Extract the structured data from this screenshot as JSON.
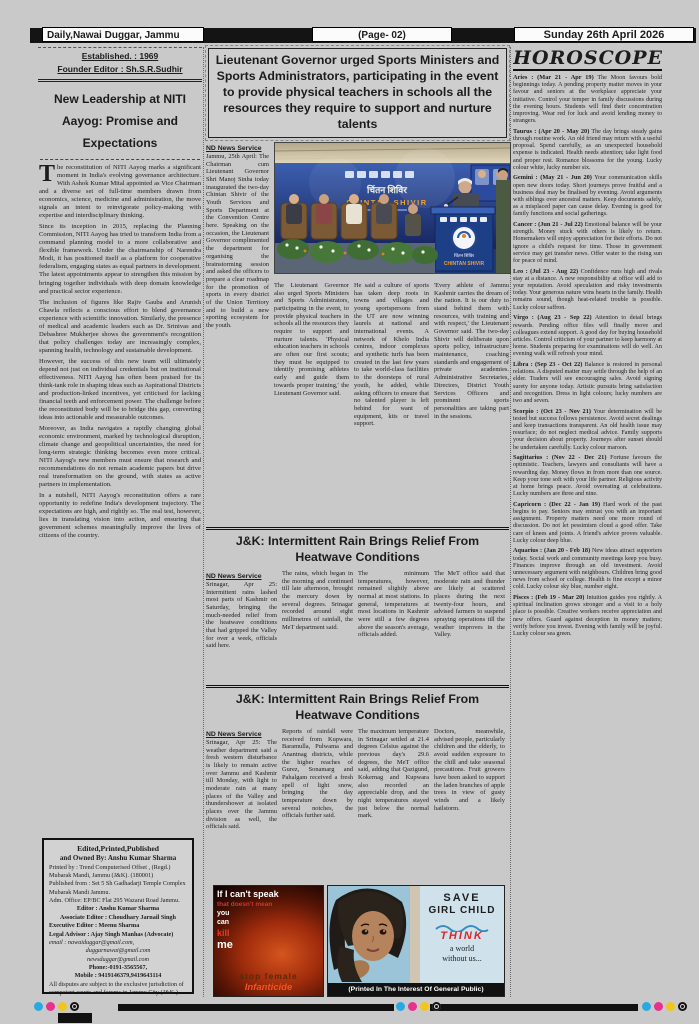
{
  "header": {
    "paper_name": "Daily,Nawai Duggar, Jammu",
    "page_label": "(Page- 02)",
    "date": "Sunday 26th April 2026"
  },
  "masthead": {
    "established": "Established. : 1969",
    "founder": "Founder Editor : Sh.S.R.Sudhir"
  },
  "editorial": {
    "title": "New Leadership at NITI Aayog: Promise and Expectations",
    "dropcap": "T",
    "paragraphs": [
      "he reconstitution of NITI Aayog marks a significant moment in India's evolving governance architecture. With Ashok Kumar Mital appointed as Vice Chairman and a diverse set of full-time members drawn from economics, science, medicine and administration, the move signals an intent to reinvigorate policy-making with expertise and interdisciplinary thinking.",
      "Since its inception in 2015, replacing the Planning Commission, NITI Aayog has tried to transform India from a command planning model to a more collaborative and flexible framework. Under the chairmanship of Narendra Modi, it has positioned itself as a platform for cooperative federalism, engaging states as equal partners in development. The latest appointments appear to strengthen this mission by bringing together individuals with deep domain knowledge and practical sector experience.",
      "The inclusion of figures like Rajiv Gauba and Arunish Chawla reflects a conscious effort to blend governance experience with scientific innovation. Similarly, the presence of medical and academic leaders such as Dr. Srinivas and Debashree Mukherjee shows the government's recognition that policy challenges today are increasingly complex, spanning health, technology and sustainable development.",
      "However, the success of this new team will ultimately depend not just on individual credentials but on institutional effectiveness. NITI Aayog has often been praised for its think-tank role in shaping ideas such as Aspirational Districts and production-linked incentives, yet criticised for lacking financial teeth and enforcement power. The challenge before the reconstituted body will be to bridge this gap, converting ideas into actionable and measurable outcomes.",
      "Moreover, as India navigates a rapidly changing global economic environment, marked by technological disruption, climate change and geopolitical uncertainties, the need for long-term strategic thinking becomes even more critical. NITI Aayog's new members must ensure that research and recommendations do not remain academic papers but drive real transformation on the ground, with states as active partners in implementation.",
      "In a nutshell, NITI Aayog's reconstitution offers a rare opportunity to redefine India's development trajectory. The expectations are high, and rightly so. The real test, however, lies in translating vision into action, and ensuring that government schemes meaningfully improve the lives of citizens of the country."
    ]
  },
  "main_article": {
    "headline": "Lieutenant Governor urged Sports Ministers and Sports Administrators, participating in the event to provide physical teachers in schools all the resources they require to support and nurture talents",
    "byline": "ND News Service",
    "col1": "Jammu, 25th April: The Chairman cum Lieutenant Governor Shri Manoj Sinha today inaugurated the two-day Chintan Shivir of the Youth Services and Sports Department at the Convention Centre here. Speaking on the occasion, the Lieutenant Governor complimented the department for organising the brainstorming session and asked the officers to prepare a clear roadmap for the promotion of sports in every district of the Union Territory and to build a new sporting ecosystem for the youth.",
    "col2": "The Lieutenant Governor also urged Sports Ministers and Sports Administrators, participating in the event, to provide physical teachers in schools all the resources they require to support and nurture talents. 'Physical education teachers in schools are often our first scouts; they must be equipped to identify promising athletes early and guide them towards proper training,' the Lieutenant Governor said.",
    "col3": "He said a culture of sports has taken deep roots in towns and villages and young sportspersons from the UT are now winning laurels at national and international events. A network of Khelo India centres, indoor complexes and synthetic turfs has been created in the last few years to take world-class facilities to the doorsteps of rural youth, he added, while asking officers to ensure that no talented player is left behind for want of equipment, kits or travel support.",
    "col4": "'Every athlete of Jammu Kashmir carries the dream of the nation. It is our duty to stand behind them with resources, with training and with respect,' the Lieutenant Governor said. The two-day Shivir will deliberate upon sports policy, infrastructure maintenance, coaching standards and engagement of private academies. Administrative Secretaries, Directors, District Youth Services Officers and prominent sports personalities are taking part in the sessions.",
    "photo": {
      "banner_hi": "चिंतन शिविर",
      "banner_en": "CHINTAN SHIVIR",
      "podium_hi": "चिंतन शिविर",
      "podium_en": "CHINTAN SHIVIR"
    }
  },
  "rain_article_1": {
    "headline": "J&K: Intermittent Rain Brings Relief From Heatwave Conditions",
    "byline": "ND News Service",
    "cols": [
      "Srinagar, Apr 25: Intermittent rains lashed most parts of Kashmir on Saturday, bringing the much-needed relief from the heatwave conditions that had gripped the Valley for over a week, officials said here.",
      "The rains, which began in the morning and continued till late afternoon, brought the mercury down by several degrees. Srinagar recorded around eight millimetres of rainfall, the MeT department said.",
      "The minimum temperatures, however, remained slightly above normal at most stations. In general, temperatures at most locations in Kashmir were still a few degrees above the season's average, officials added.",
      "The MeT office said that moderate rain and thunder are likely at scattered places during the next twenty-four hours, and advised farmers to suspend spraying operations till the weather improves in the Valley."
    ]
  },
  "rain_article_2": {
    "headline": "J&K: Intermittent Rain Brings Relief From Heatwave Conditions",
    "byline": "ND News Service",
    "cols": [
      "Srinagar, Apr 25: The weather department said a fresh western disturbance is likely to remain active over Jammu and Kashmir till Monday, with light to moderate rain at many places of the Valley and thundershower at isolated places over the Jammu division as well, the officials said.",
      "Reports of rainfall were received from Kupwara, Baramulla, Pulwama and Anantnag districts, while the higher reaches of Gurez, Sonamarg and Pahalgam received a fresh spell of light snow, bringing the day temperature down by several notches, the officials further said.",
      "The maximum temperature in Srinagar settled at 21.4 degrees Celsius against the previous day's 29.6 degrees, the MeT office said, adding that Qazigund, Kokernag and Kupwara also recorded an appreciable drop, and the night temperatures stayed just below the normal mark.",
      "Doctors, meanwhile, advised people, particularly children and the elderly, to avoid sudden exposure to the chill and take seasonal precautions. Fruit growers have been asked to support the laden branches of apple trees in view of gusty winds and a likely hailstorm."
    ]
  },
  "imprint": {
    "lines": [
      "Edited,Printed,Published",
      "and Owned By: Anshu Kumar Sharma",
      "Printed by :  Trend Computerised Offset , (Regd.) Mubarak Mandi, Jammu (J&K). (180001)",
      "Published from : Set 5 Sh Gadhadarji Temple Complex Mubarak Mandi Jammu.",
      "Adm. Office: EP/BC Flat 295 Wazarat Road Jammu.",
      "Editor : Anshu Kumar Sharma",
      "Associate Editor : Choudhary Jarnail  Singh",
      "Executive Editor : Meenu Sharma",
      "Legal Advisor : Ajay Singh Manhas (Advocate)",
      "email :        nawaiduggar@gmail.com,",
      "duggarnawai@gmail.com",
      "newsduggar@gmail.com",
      "Phone:-0191-3565567,",
      "Mobile : 9419146379,9419643114",
      "All disputes are subject to the exclusive jurisdiction of competent courts  and forums in Jammu City (J&K )"
    ]
  },
  "ads": {
    "infanticide": {
      "line1": "If I can't speak",
      "line2": "that doesn't mean",
      "line3": "you",
      "line4": "can",
      "line5": "kill",
      "line6": "me",
      "line7": "stop female",
      "line8": "Infanticide"
    },
    "save_girl": {
      "line1": "SAVE",
      "line2": "GIRL CHILD",
      "line3": "THINK",
      "line4": "a world",
      "line5": "without us...",
      "footer": "(Printed In The Interest Of General Public)"
    }
  },
  "horoscope": {
    "title": "HOROSCOPE",
    "entries": [
      {
        "heading": "Aries : (Mar 21 - Apr 19)",
        "text": "The Moon favours bold beginnings today. A pending property matter moves in your favour and seniors at the workplace appreciate your initiative. Control your temper in family discussions during the evening hours. Students will find their concentration improving. Wear red for luck and avoid lending money to strangers."
      },
      {
        "heading": "Taurus : (Apr 20 - May 20)",
        "text": "The day brings steady gains through routine work. An old friend may return with a useful proposal. Spend carefully, as an unexpected household expense is indicated. Health needs attention; take light food and proper rest. Romance blossoms for the young. Lucky colour white, lucky number six."
      },
      {
        "heading": "Gemini : (May 21 - Jun 20)",
        "text": "Your communication skills open new doors today. Short journeys prove fruitful and a business deal may be finalised by evening. Avoid arguments with siblings over ancestral matters. Keep documents safely, as a misplaced paper can cause delay. Evening is good for family functions and social gatherings."
      },
      {
        "heading": "Cancer : (Jun 21 - Jul 22)",
        "text": "Emotional balance will be your strength. Money stuck with others is likely to return. Homemakers will enjoy appreciation for their efforts. Do not ignore a child's request for time. Those in government service may get transfer news. Offer water to the rising sun for peace of mind."
      },
      {
        "heading": "Leo : (Jul 23 - Aug 22)",
        "text": "Confidence runs high and rivals stay at a distance. A new responsibility at office will add to your reputation. Avoid speculation and risky investments today. Your generous nature wins hearts in the family. Health remains sound, though heat-related trouble is possible. Lucky colour saffron."
      },
      {
        "heading": "Virgo : (Aug 23 - Sep 22)",
        "text": "Attention to detail brings rewards. Pending office files will finally move and colleagues extend support. A good day for buying household articles. Control criticism of your partner to keep harmony at home. Students preparing for examinations will do well. An evening walk will refresh your mind."
      },
      {
        "heading": "Libra : (Sep 23 - Oct 22)",
        "text": "Balance is restored in personal relations. A disputed matter may settle through the help of an elder. Traders will see encouraging sales. Avoid signing surety for anyone today. Artistic pursuits bring satisfaction and recognition. Dress in light colours; lucky numbers are two and seven."
      },
      {
        "heading": "Scorpio : (Oct 23 - Nov 21)",
        "text": "Your determination will be tested but success follows persistence. Avoid secret dealings and keep transactions transparent. An old health issue may resurface; do not neglect medical advice. Family supports your decision about property. Journeys after sunset should be undertaken carefully. Lucky colour maroon."
      },
      {
        "heading": "Sagittarius : (Nov 22 - Dec 21)",
        "text": "Fortune favours the optimistic. Teachers, lawyers and consultants will have a rewarding day. Money flows in from more than one source. Keep your tone soft with your life partner. Religious activity at home brings peace. Avoid overeating at celebrations. Lucky numbers are three and nine."
      },
      {
        "heading": "Capricorn : (Dec 22 - Jan 19)",
        "text": "Hard work of the past begins to pay. Seniors may entrust you with an important assignment. Property matters need one more round of discussion. Do not let pessimism cloud a good offer. Take care of knees and joints. A friend's advice proves valuable. Lucky colour deep blue."
      },
      {
        "heading": "Aquarius : (Jan 20 - Feb 18)",
        "text": "New ideas attract supporters today. Social work and community meetings keep you busy. Finances improve through an old investment. Avoid unnecessary argument with neighbours. Children bring good news from school or college. Health is fine except a minor cold. Lucky colour sky blue, number eight."
      },
      {
        "heading": "Pisces : (Feb 19 - Mar 20)",
        "text": "Intuition guides you rightly. A spiritual inclination grows stronger and a visit to a holy place is possible. Creative workers receive appreciation and new offers. Guard against deception in money matters; verify before you invest. Evening with family will be joyful. Lucky colour sea green."
      }
    ]
  },
  "print_marks": {
    "cyan": "#2aa9e0",
    "magenta": "#e6318e",
    "yellow": "#f2c51d",
    "black": "#141414"
  }
}
